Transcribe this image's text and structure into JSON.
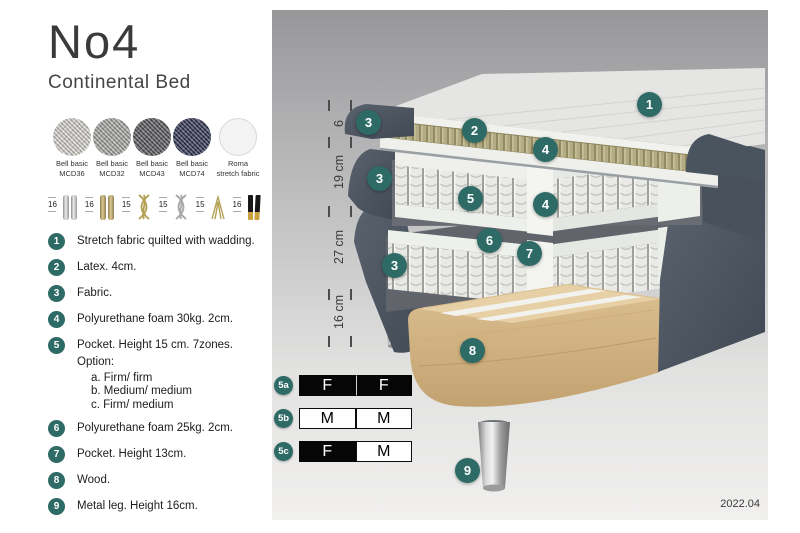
{
  "brand": {
    "title": "No4",
    "subtitle": "Continental Bed"
  },
  "fabric_swatches": [
    {
      "line1": "Bell basic",
      "line2": "MCD36",
      "color": "#d8d6d1",
      "texture": "woven"
    },
    {
      "line1": "Bell basic",
      "line2": "MCD32",
      "color": "#a8a8a5",
      "texture": "woven"
    },
    {
      "line1": "Bell basic",
      "line2": "MCD43",
      "color": "#57575a",
      "texture": "woven"
    },
    {
      "line1": "Bell basic",
      "line2": "MCD74",
      "color": "#2e3251",
      "texture": "woven"
    },
    {
      "line1": "Roma",
      "line2": "stretch fabric",
      "color": "#f3f3f3",
      "texture": "plain"
    }
  ],
  "leg_options": [
    {
      "height": "16",
      "finish": "chrome-pair"
    },
    {
      "height": "16",
      "finish": "brass-pair"
    },
    {
      "height": "15",
      "finish": "twist-gold"
    },
    {
      "height": "15",
      "finish": "twist-silver"
    },
    {
      "height": "15",
      "finish": "hairpin-gold"
    },
    {
      "height": "16",
      "finish": "taper-black-gold"
    }
  ],
  "features": [
    {
      "num": "1",
      "text": "Stretch fabric quilted with wadding."
    },
    {
      "num": "2",
      "text": "Latex. 4cm."
    },
    {
      "num": "3",
      "text": "Fabric."
    },
    {
      "num": "4",
      "text": "Polyurethane foam 30kg. 2cm."
    },
    {
      "num": "5",
      "text": "Pocket. Height 15 cm. 7zones. Option:",
      "sub": [
        "a. Firm/ firm",
        "b. Medium/ medium",
        "c. Firm/ medium"
      ]
    },
    {
      "num": "6",
      "text": "Polyurethane foam 25kg. 2cm."
    },
    {
      "num": "7",
      "text": "Pocket. Height 13cm."
    },
    {
      "num": "8",
      "text": "Wood."
    },
    {
      "num": "9",
      "text": "Metal leg. Height 16cm."
    }
  ],
  "diagram": {
    "ruler_segments": [
      {
        "label": "6"
      },
      {
        "label": "19 cm"
      },
      {
        "label": "27 cm"
      },
      {
        "label": "16 cm"
      }
    ],
    "callouts": [
      {
        "n": "1"
      },
      {
        "n": "2"
      },
      {
        "n": "3"
      },
      {
        "n": "3"
      },
      {
        "n": "3"
      },
      {
        "n": "4"
      },
      {
        "n": "4"
      },
      {
        "n": "5"
      },
      {
        "n": "6"
      },
      {
        "n": "7"
      },
      {
        "n": "8"
      },
      {
        "n": "9"
      }
    ],
    "firmness": [
      {
        "id": "5a",
        "cells": [
          {
            "letter": "F",
            "tone": "dark"
          },
          {
            "letter": "F",
            "tone": "dark"
          }
        ]
      },
      {
        "id": "5b",
        "cells": [
          {
            "letter": "M",
            "tone": "light"
          },
          {
            "letter": "M",
            "tone": "light"
          }
        ]
      },
      {
        "id": "5c",
        "cells": [
          {
            "letter": "F",
            "tone": "dark"
          },
          {
            "letter": "M",
            "tone": "light"
          }
        ]
      }
    ],
    "version": "2022.04"
  },
  "colors": {
    "accent_teal": "#2e6b66",
    "bed_fabric": "#4d5661",
    "latex": "#b2ab83",
    "wood": "#e0c99e"
  }
}
